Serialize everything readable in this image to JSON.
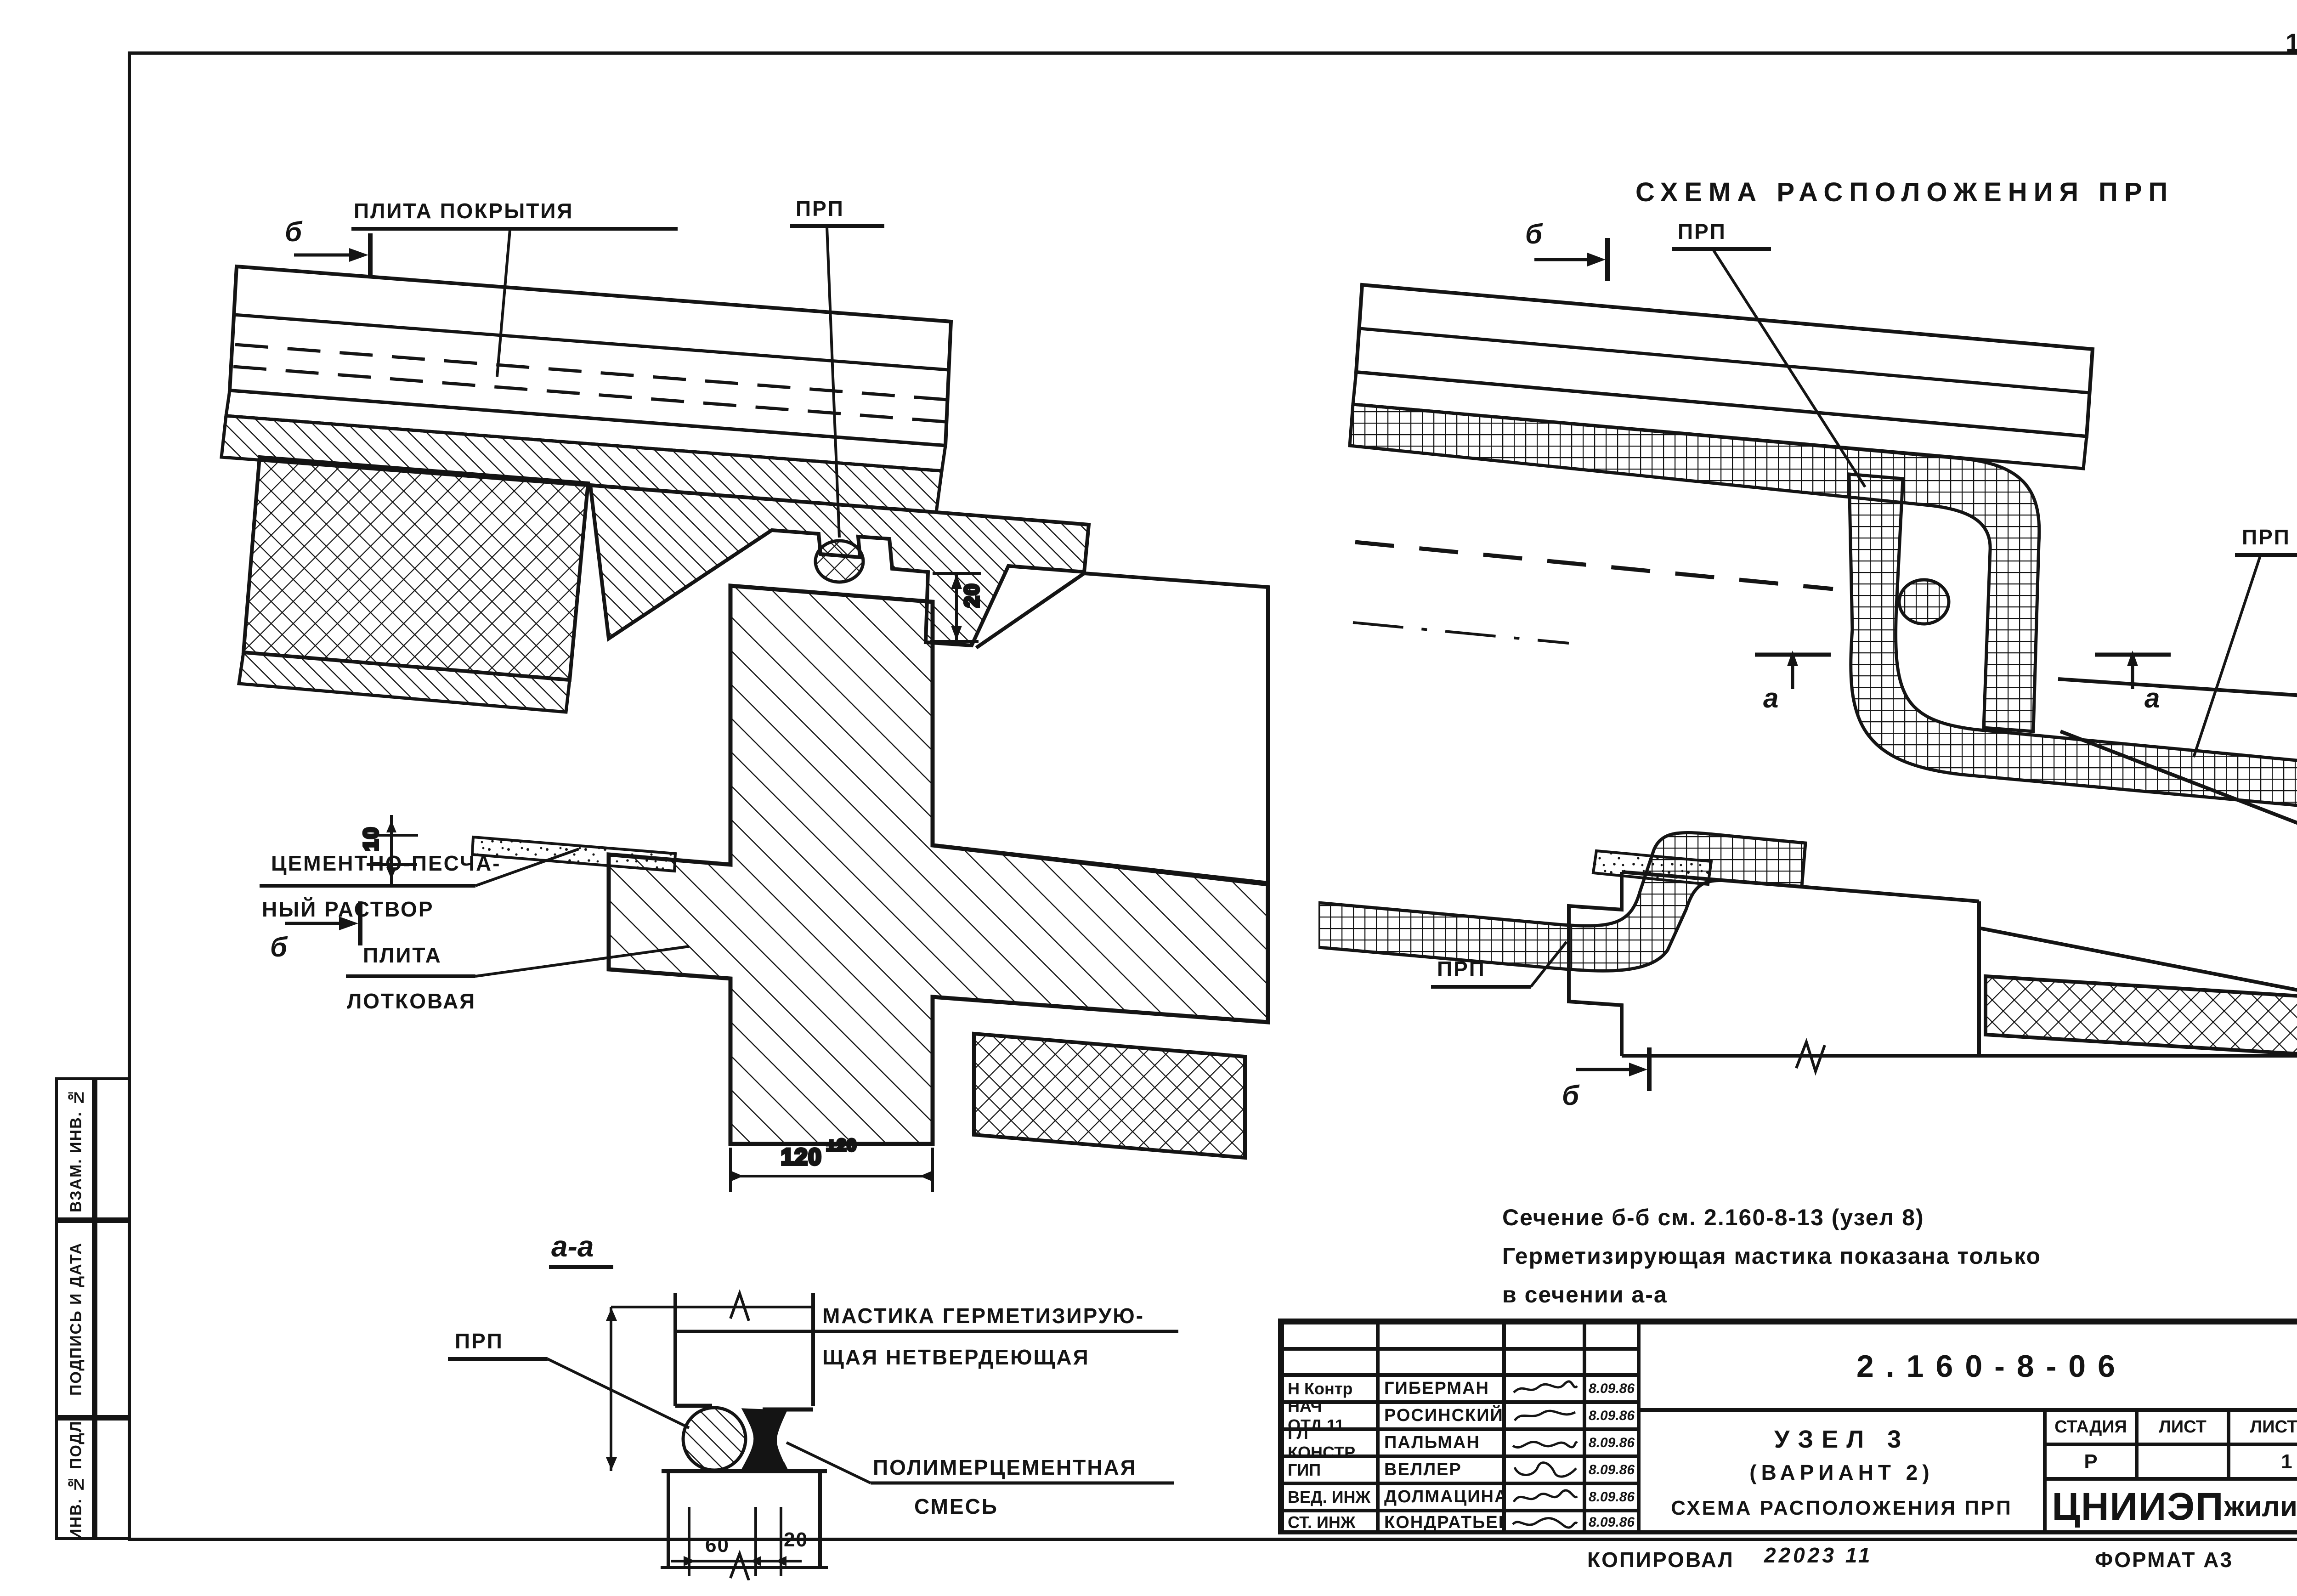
{
  "page": {
    "number": "10"
  },
  "left_stamp": {
    "box1": "ВЗАМ. ИНВ. №",
    "box2": "ПОДПИСЬ И ДАТА",
    "box3": "ИНВ. № ПОДЛ."
  },
  "left_detail": {
    "label_roof_slab": "ПЛИТА ПОКРЫТИЯ",
    "label_prp": "ПРП",
    "label_cement_line1": "ЦЕМЕНТНО-ПЕСЧА-",
    "label_cement_line2": "НЫЙ РАСТВОР",
    "label_tray_line1": "ПЛИТА",
    "label_tray_line2": "ЛОТКОВАЯ",
    "dim_gap": "20",
    "dim_bed": "10",
    "dim_width": "120",
    "dim_width_tol": "±20",
    "section_mark_top": "б",
    "section_mark_bottom": "б"
  },
  "right_detail": {
    "title": "СХЕМА РАСПОЛОЖЕНИЯ ПРП",
    "section_mark_top": "б",
    "section_mark_bottom": "б",
    "label_prp_top": "ПРП",
    "label_prp_right": "ПРП",
    "label_prp_bottom": "ПРП",
    "section_mark_a_left": "a",
    "section_mark_a_right": "a"
  },
  "section_aa": {
    "title": "а-а",
    "label_prp": "ПРП",
    "label_mastic_line1": "МАСТИКА ГЕРМЕТИЗИРУЮ-",
    "label_mastic_line2": "ЩАЯ НЕТВЕРДЕЮЩАЯ",
    "label_polymer_line1": "ПОЛИМЕРЦЕМЕНТНАЯ",
    "label_polymer_line2": "СМЕСЬ",
    "dim_60": "60",
    "dim_20": "20"
  },
  "note": {
    "line1": "Сечение б-б см. 2.160-8-13 (узел 8)",
    "line2": "Герметизирующая мастика показана только",
    "line3": "в  сечении  а-а"
  },
  "title_block": {
    "code": "2.160-8-06",
    "rows": [
      {
        "role": "Н Контр",
        "name": "ГИБЕРМАН",
        "date": "8.09.86"
      },
      {
        "role": "НАЧ ОТД.11",
        "name": "РОСИНСКИЙ",
        "date": "8.09.86"
      },
      {
        "role": "ГЛ КОНСТР.",
        "name": "ПАЛЬМАН",
        "date": "8.09.86"
      },
      {
        "role": "ГИП",
        "name": "ВЕЛЛЕР",
        "date": "8.09.86"
      },
      {
        "role": "ВЕД. ИНЖ",
        "name": "ДОЛМАЦИНА",
        "date": "8.09.86"
      },
      {
        "role": "СТ. ИНЖ",
        "name": "КОНДРАТЬЕВА",
        "date": "8.09.86"
      }
    ],
    "title_line1": "УЗЕЛ 3",
    "title_line2": "(ВАРИАНТ 2)",
    "title_line3": "СХЕМА РАСПОЛОЖЕНИЯ ПРП",
    "stage_label": "СТАДИЯ",
    "sheet_label": "ЛИСТ",
    "sheets_label": "ЛИСТОВ",
    "stage_value": "Р",
    "sheet_value": "",
    "sheets_value": "1",
    "org_part1": "ЦНИИЭП",
    "org_part2": "жилища"
  },
  "footer": {
    "copied_label": "КОПИРОВАЛ",
    "copied_value": "22023   11",
    "format_label": "ФОРМАТ А3"
  },
  "colors": {
    "ink": "#141414",
    "paper": "#ffffff"
  }
}
